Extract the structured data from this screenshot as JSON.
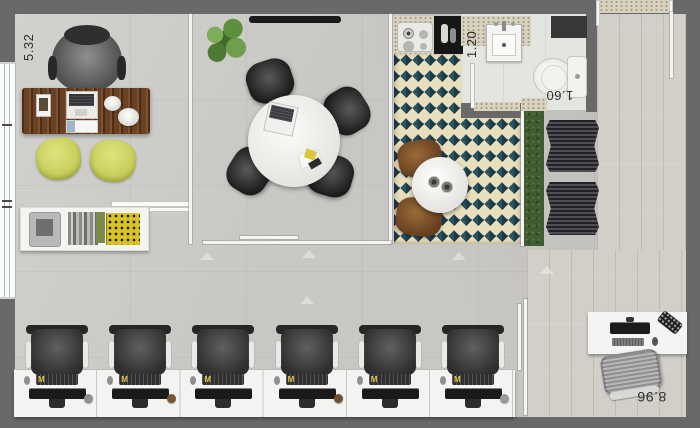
{
  "plan": {
    "type": "office-floor-plan",
    "dimensions": {
      "left_wall": "5.32",
      "sink_width": "1.20",
      "wc_width": "1.60",
      "bottom_width": "8.96"
    },
    "colors": {
      "exterior_wall": "#696969",
      "concrete_floor": "#c8c7c3",
      "wood_floor": "#d2cfc8",
      "rug_teal": "#2a5260",
      "rug_navy": "#1d3c4a",
      "rug_cream": "#e9dfbd",
      "hedge_green": "#3f5c33",
      "exec_desk_wood": "#6b4124",
      "guest_chair_yellow": "#c3cb55"
    }
  },
  "workstations": {
    "count": 6,
    "keyboard_logo": "M",
    "accessory_colors": [
      "#8f8f8d",
      "#7a5636",
      null,
      "#6f4f30",
      null,
      "#999997"
    ]
  }
}
